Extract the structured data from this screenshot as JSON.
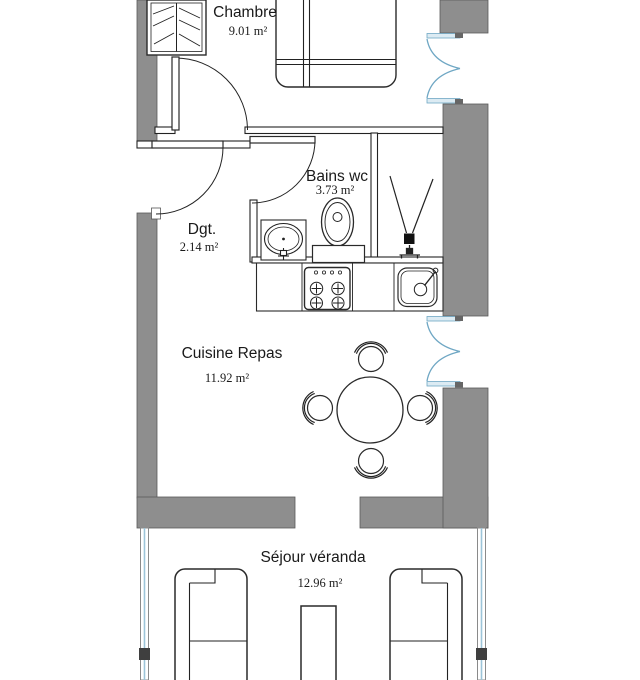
{
  "plan": {
    "type": "apartment-floor-plan",
    "rooms": {
      "chambre": {
        "name": "Chambre",
        "area": "9.01 m²"
      },
      "bains": {
        "name": "Bains wc",
        "area": "3.73 m²"
      },
      "dgt": {
        "name": "Dgt.",
        "area": "2.14 m²"
      },
      "cuisine": {
        "name": "Cuisine Repas",
        "area": "11.92 m²"
      },
      "sejour": {
        "name": "Séjour véranda",
        "area": "12.96 m²"
      }
    },
    "colors": {
      "wall_gray": "#8e8e8e",
      "window_blue": "#6fa7c4",
      "glass_blue": "#9cc4d8",
      "line_black": "#1a1a1a",
      "background": "#ffffff"
    },
    "fixtures": [
      "wardrobe",
      "double-bed",
      "entrance-door",
      "interior-doors",
      "washbasin",
      "toilet",
      "shower-drain",
      "stove",
      "kitchen-sink",
      "round-dining-table",
      "four-chairs",
      "two-sofas",
      "coffee-table",
      "french-windows",
      "veranda-glazing"
    ]
  }
}
